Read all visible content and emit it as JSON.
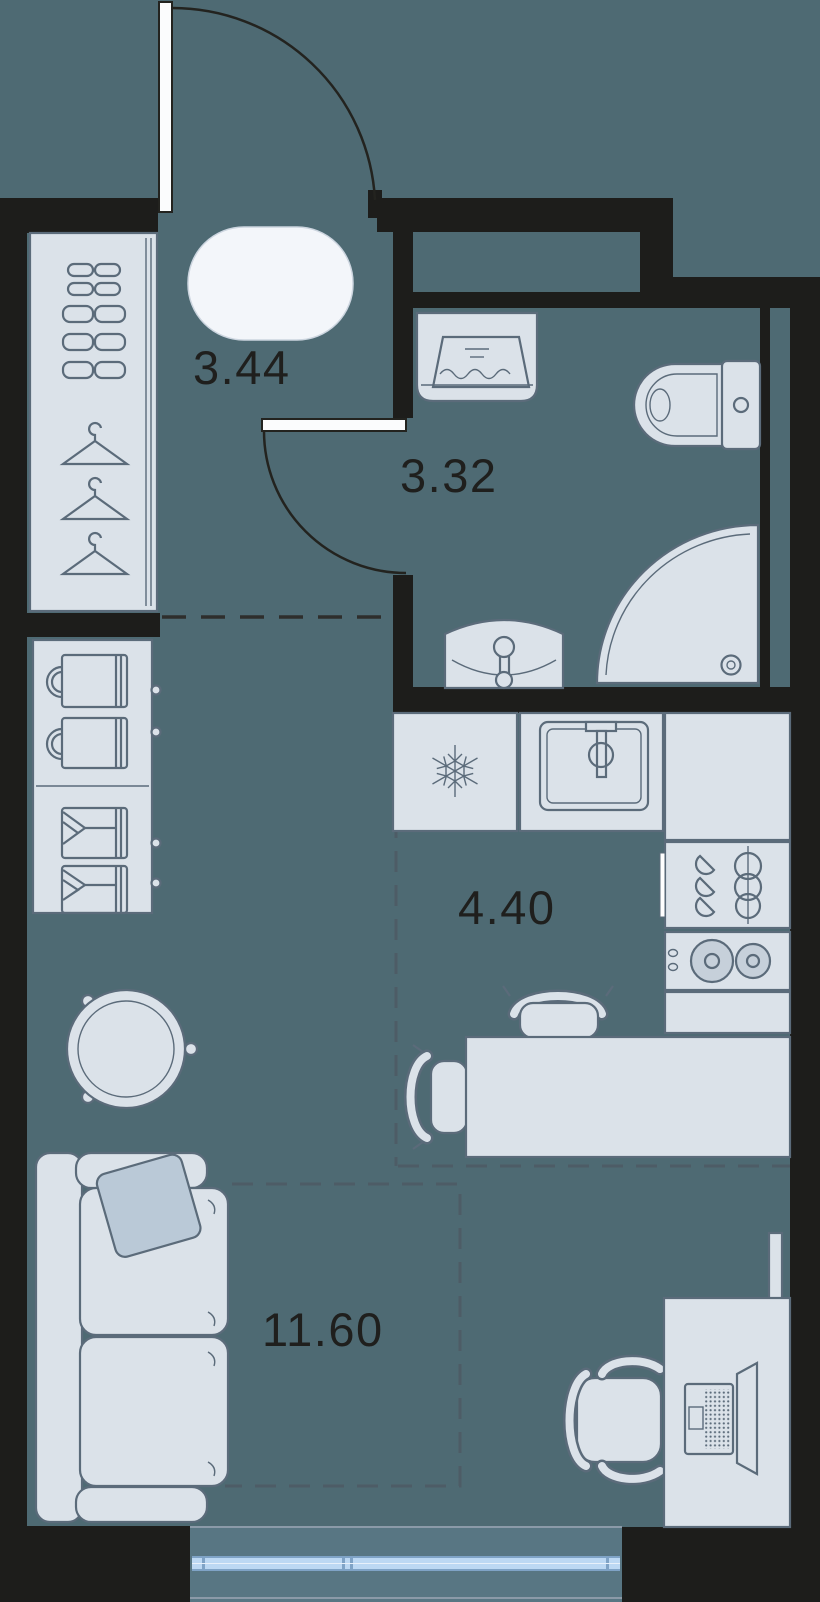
{
  "plan": {
    "rooms": {
      "hallway": {
        "area_label": "3.44"
      },
      "bathroom": {
        "area_label": "3.32"
      },
      "kitchen": {
        "area_label": "4.40"
      },
      "living_room": {
        "area_label": "11.60"
      }
    },
    "colors": {
      "wall": "#1d1d1b",
      "floor": "#4e6a73",
      "balcony_floor": "#587683",
      "furniture_fill": "#dbe2e9",
      "furniture_outline": "#5b6b7a",
      "window_glass": "#bcd8f3",
      "label_text": "#1f1f1d"
    },
    "fixtures": [
      "entry-door",
      "wardrobe",
      "shoe-shelf",
      "clothes-hangers",
      "rug",
      "washing-machine",
      "toilet",
      "shower",
      "washbasin",
      "bathroom-door",
      "refrigerator",
      "kitchen-sink",
      "dish-rack",
      "stove",
      "kitchen-counter",
      "dining-table",
      "dining-chairs",
      "round-table",
      "storage-cabinet",
      "sofa",
      "pillow",
      "desk",
      "office-chair",
      "laptop",
      "tv",
      "balcony-window"
    ]
  }
}
